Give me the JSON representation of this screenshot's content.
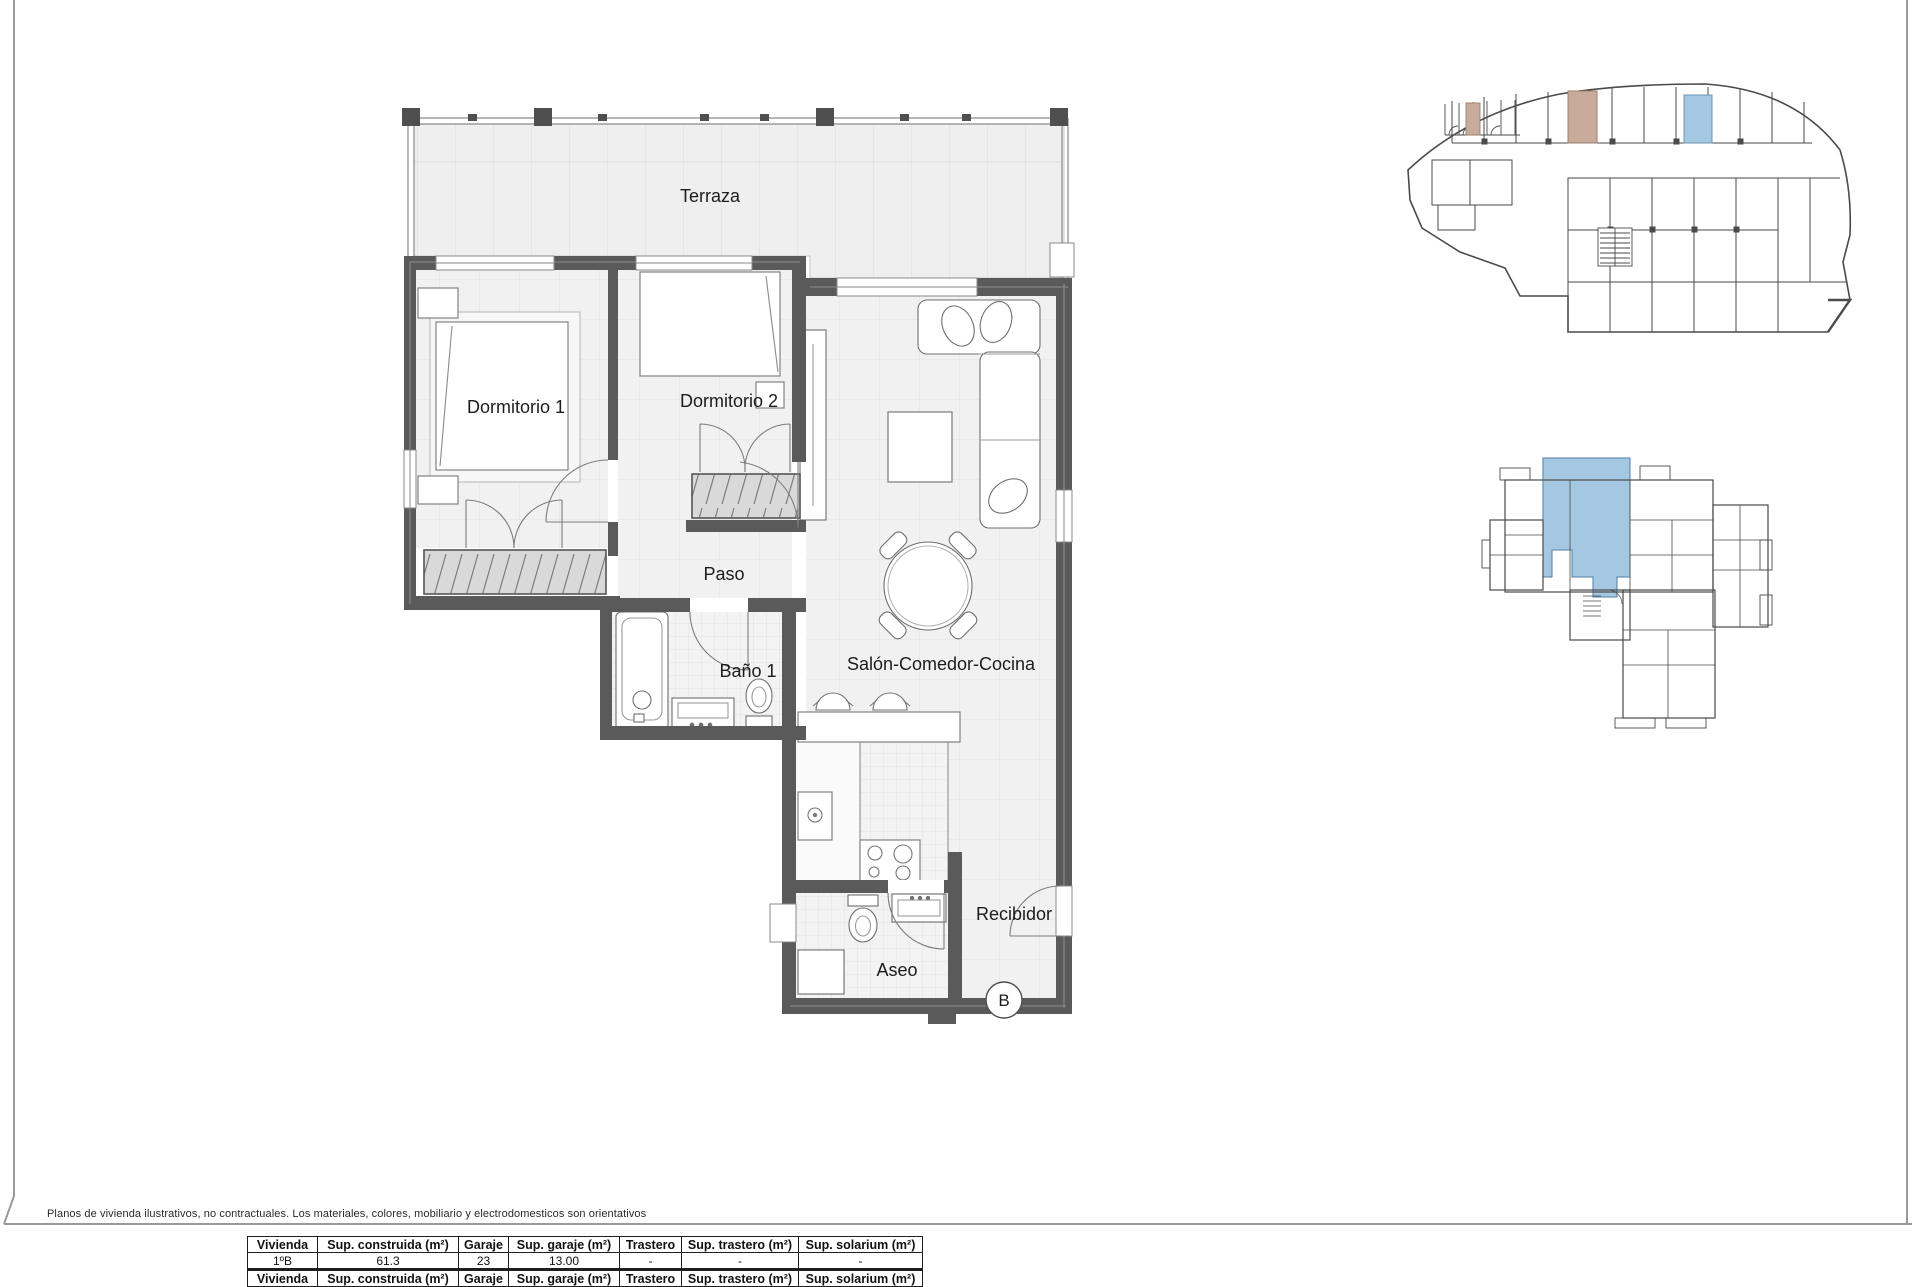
{
  "colors": {
    "wall": "#5a5a5a",
    "floor": "#f1f1f2",
    "grid": "#e2e2e2",
    "highlight_blue": "#a5c8e2",
    "highlight_tan": "#c9ab9c",
    "keyplan_line": "#4a4a4a"
  },
  "plan": {
    "rooms": {
      "terraza": "Terraza",
      "dormitorio1": "Dormitorio 1",
      "dormitorio2": "Dormitorio 2",
      "paso": "Paso",
      "bano1": "Baño 1",
      "salon": "Salón-Comedor-Cocina",
      "aseo": "Aseo",
      "recibidor": "Recibidor"
    },
    "unit_marker": "B"
  },
  "footer": {
    "disclaimer": "Planos de vivienda ilustrativos, no contractuales. Los materiales, colores, mobiliario y electrodomesticos son orientativos"
  },
  "table": {
    "headers": [
      "Vivienda",
      "Sup. construida (m²)",
      "Garaje",
      "Sup. garaje (m²)",
      "Trastero",
      "Sup. trastero (m²)",
      "Sup. solarium (m²)"
    ],
    "row": [
      "1ºB",
      "61.3",
      "23",
      "13.00",
      "-",
      "-",
      "-"
    ]
  }
}
